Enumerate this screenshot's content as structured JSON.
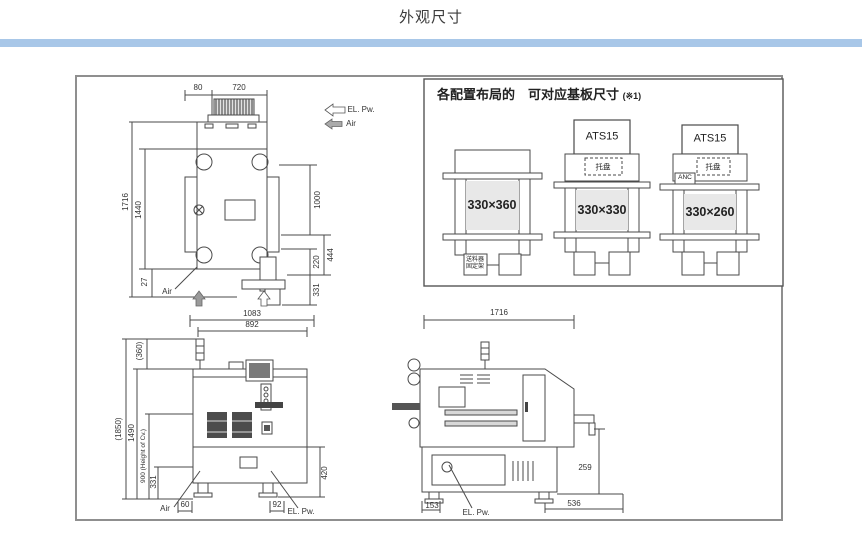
{
  "page": {
    "title": "外观尺寸",
    "accent_color": "#a8c7e8"
  },
  "config_panel": {
    "title": "各配置布局的　可对应基板尺寸",
    "note": "(※1)",
    "configs": [
      {
        "size": "330×360",
        "feeder_line1": "送料器",
        "feeder_line2": "固定架"
      },
      {
        "top_label": "ATS15",
        "tray_label": "托盘",
        "size": "330×330"
      },
      {
        "top_label": "ATS15",
        "tray_label": "托盘",
        "anc_label": "ANC",
        "size": "330×260"
      }
    ]
  },
  "top_view": {
    "dim_80": "80",
    "dim_720": "720",
    "dim_1716": "1716",
    "dim_1440": "1440",
    "dim_1000": "1000",
    "dim_444": "444",
    "dim_220": "220",
    "dim_331": "331",
    "dim_27": "27",
    "air_label": "Air",
    "el_pw_label": "EL. Pw.",
    "air_top_label": "Air"
  },
  "front_view": {
    "dim_1083": "1083",
    "dim_892": "892",
    "dim_360": "(360)",
    "dim_1850": "(1850)",
    "dim_1490": "1490",
    "dim_900": "900 (Height of Cv.)",
    "dim_331": "331",
    "dim_420": "420",
    "dim_60": "60",
    "dim_92": "92",
    "air_label": "Air",
    "el_pw_label": "EL. Pw."
  },
  "side_view": {
    "dim_1716": "1716",
    "dim_259": "259",
    "dim_153": "153",
    "dim_536": "536",
    "el_pw_label": "EL. Pw."
  }
}
